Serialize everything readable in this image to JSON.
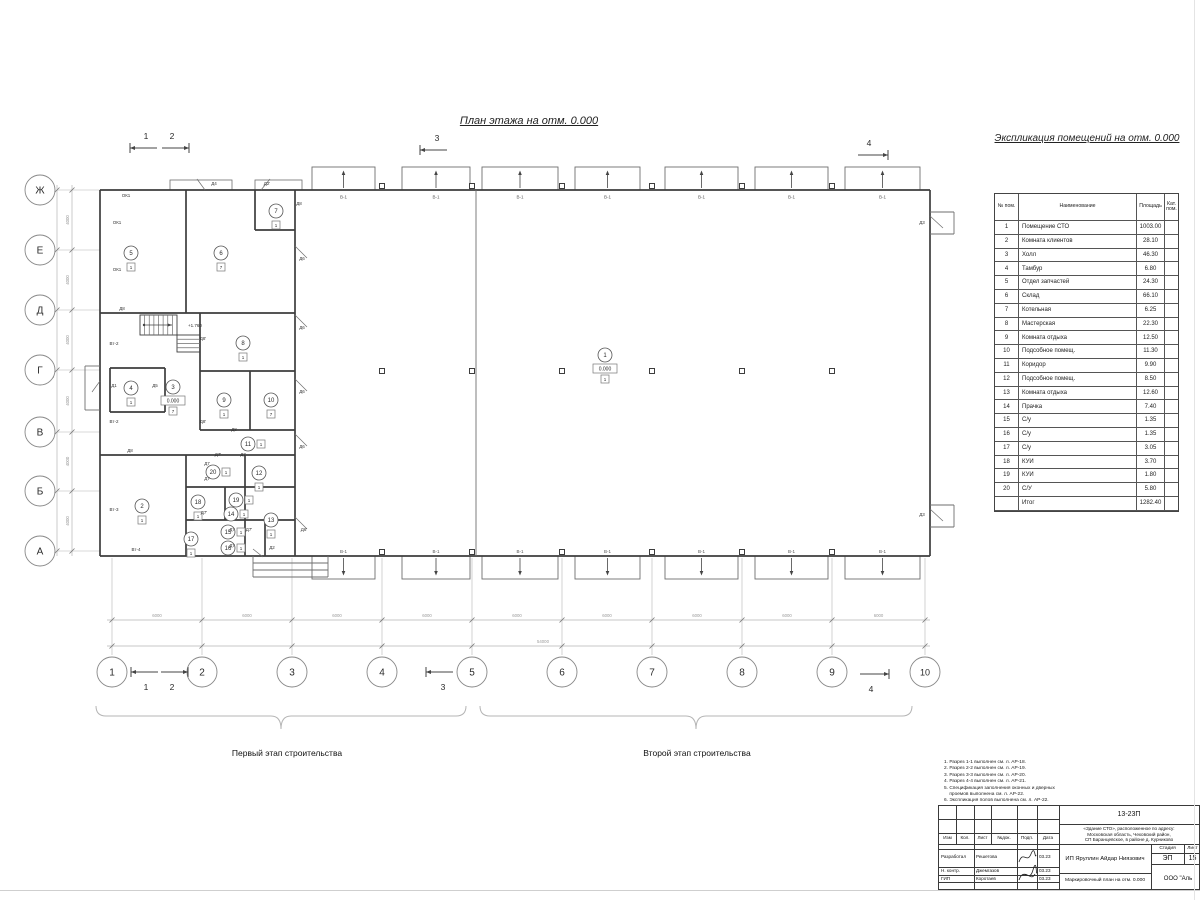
{
  "titles": {
    "plan": "План этажа на отм. 0.000",
    "schedule": "Экспликация помещений на отм. 0.000"
  },
  "stages": {
    "first": "Первый этап строительства",
    "second": "Второй этап строительства"
  },
  "schedule_table": {
    "headers": [
      "№ пом.",
      "Наименование",
      "Площадь",
      "Кат. пом."
    ],
    "rows": [
      [
        "1",
        "Помещение СТО",
        "1003.00",
        ""
      ],
      [
        "2",
        "Комната клиентов",
        "28.10",
        ""
      ],
      [
        "3",
        "Холл",
        "46.30",
        ""
      ],
      [
        "4",
        "Тамбур",
        "6.80",
        ""
      ],
      [
        "5",
        "Отдел запчастей",
        "24.30",
        ""
      ],
      [
        "6",
        "Склад",
        "66.10",
        ""
      ],
      [
        "7",
        "Котельная",
        "6.25",
        ""
      ],
      [
        "8",
        "Мастерская",
        "22.30",
        ""
      ],
      [
        "9",
        "Комната отдыха",
        "12.50",
        ""
      ],
      [
        "10",
        "Подсобное помещ.",
        "11.30",
        ""
      ],
      [
        "11",
        "Коридор",
        "9.90",
        ""
      ],
      [
        "12",
        "Подсобное помещ.",
        "8.50",
        ""
      ],
      [
        "13",
        "Комната отдыха",
        "12.60",
        ""
      ],
      [
        "14",
        "Прачка",
        "7.40",
        ""
      ],
      [
        "15",
        "С/у",
        "1.35",
        ""
      ],
      [
        "16",
        "С/у",
        "1.35",
        ""
      ],
      [
        "17",
        "С/у",
        "3.05",
        ""
      ],
      [
        "18",
        "КУИ",
        "3.70",
        ""
      ],
      [
        "19",
        "КУИ",
        "1.80",
        ""
      ],
      [
        "20",
        "С/У",
        "5.80",
        ""
      ],
      [
        "",
        "Итог",
        "1282.40",
        ""
      ]
    ]
  },
  "notes": {
    "lines": [
      "1. Разрез 1-1 выполнен см. л. АР-18.",
      "2. Разрез 2-2 выполнен см. л. АР-19.",
      "3. Разрез 3-3 выполнен см. л. АР-20.",
      "4. Разрез 4-4 выполнен см. л. АР-21.",
      "5. Спецификация заполнения оконных и дверных",
      "    проемов выполнена см. л. АР-22.",
      "6. Экспликация полов выполнена см. л. АР-22."
    ]
  },
  "titleblock": {
    "doc_number": "13-23П",
    "object_lines": [
      "«Здание СТО», расположенное по адресу:",
      "Московская область, Чеховский район,",
      "СП Баранцевское, в районе д. Курниково"
    ],
    "columns": [
      "Изм",
      "Кол.",
      "Лист",
      "№док.",
      "Подп.",
      "Дата"
    ],
    "roles": [
      {
        "role": "Разработал",
        "name": "Решетова",
        "date": "03.23"
      },
      {
        "role": "Н. контр.",
        "name": "Джемгазов",
        "date": "03.23"
      },
      {
        "role": "ГИП",
        "name": "Коротаев",
        "date": "03.23"
      }
    ],
    "client": "ИП Яруллин Айдар Ниязович",
    "stage_label": "Стадия",
    "sheet_label": "Лист",
    "stage": "ЭП",
    "sheet": "15",
    "drawing_title": "Маркировочный план на отм. 0.000",
    "company": "ООО \"Аль"
  },
  "plan": {
    "colors": {
      "dark": "#3d3d3d",
      "mid": "#6e6e6e",
      "light": "#b5b5b5",
      "dim": "#9a9a9a",
      "text": "#2a2a2a"
    },
    "gate_label": "В-1",
    "stair_note": "+1.760",
    "dim_seg_bottom": "6000",
    "dim_total_bottom": "54000",
    "dim_seg_left": "4000",
    "dim_total_left": "24000",
    "axes_bottom": [
      {
        "n": "1",
        "x": 112
      },
      {
        "n": "2",
        "x": 202
      },
      {
        "n": "3",
        "x": 292
      },
      {
        "n": "4",
        "x": 382
      },
      {
        "n": "5",
        "x": 472
      },
      {
        "n": "6",
        "x": 562
      },
      {
        "n": "7",
        "x": 652
      },
      {
        "n": "8",
        "x": 742
      },
      {
        "n": "9",
        "x": 832
      },
      {
        "n": "10",
        "x": 925
      }
    ],
    "axes_left": [
      {
        "n": "Ж",
        "y": 190
      },
      {
        "n": "Е",
        "y": 250
      },
      {
        "n": "Д",
        "y": 310
      },
      {
        "n": "Г",
        "y": 370
      },
      {
        "n": "В",
        "y": 432
      },
      {
        "n": "Б",
        "y": 491
      },
      {
        "n": "А",
        "y": 551
      }
    ],
    "bays": [
      [
        312,
        375
      ],
      [
        402,
        470
      ],
      [
        482,
        558
      ],
      [
        575,
        640
      ],
      [
        665,
        738
      ],
      [
        755,
        828
      ],
      [
        845,
        920
      ]
    ],
    "canopies": [
      [
        170,
        232
      ],
      [
        255,
        302
      ]
    ],
    "column_xs": [
      382,
      472,
      562,
      652,
      742,
      832
    ],
    "walls_main": [
      [
        100,
        190,
        930,
        190
      ],
      [
        100,
        556,
        930,
        556
      ],
      [
        100,
        190,
        100,
        556
      ],
      [
        930,
        190,
        930,
        556
      ],
      [
        100,
        313,
        295,
        313
      ],
      [
        186,
        190,
        186,
        313
      ],
      [
        255,
        190,
        255,
        230
      ],
      [
        255,
        230,
        295,
        230
      ],
      [
        295,
        190,
        295,
        556
      ],
      [
        200,
        313,
        200,
        430
      ],
      [
        200,
        371,
        295,
        371
      ],
      [
        250,
        371,
        250,
        430
      ],
      [
        200,
        430,
        295,
        430
      ],
      [
        100,
        455,
        295,
        455
      ],
      [
        186,
        455,
        186,
        556
      ],
      [
        245,
        455,
        245,
        556
      ],
      [
        186,
        487,
        295,
        487
      ],
      [
        186,
        520,
        295,
        520
      ],
      [
        265,
        520,
        265,
        556
      ],
      [
        225,
        487,
        225,
        520
      ],
      [
        110,
        368,
        165,
        368
      ],
      [
        110,
        368,
        110,
        412
      ],
      [
        165,
        368,
        165,
        412
      ],
      [
        110,
        412,
        165,
        412
      ]
    ],
    "walls_thin": [
      [
        476,
        190,
        476,
        556
      ],
      [
        85,
        366,
        100,
        366
      ],
      [
        85,
        366,
        85,
        410
      ],
      [
        85,
        410,
        100,
        410
      ],
      [
        930,
        212,
        954,
        212
      ],
      [
        954,
        212,
        954,
        234
      ],
      [
        930,
        234,
        954,
        234
      ],
      [
        930,
        505,
        954,
        505
      ],
      [
        954,
        505,
        954,
        527
      ],
      [
        930,
        527,
        954,
        527
      ],
      [
        253,
        556,
        253,
        577
      ],
      [
        253,
        577,
        328,
        577
      ],
      [
        328,
        556,
        328,
        577
      ],
      [
        253,
        563,
        328,
        563
      ],
      [
        253,
        570,
        328,
        570
      ]
    ],
    "deco_lines": [
      [
        205,
        190,
        197,
        179
      ],
      [
        261,
        190,
        270,
        179
      ],
      [
        295,
        246,
        307,
        258
      ],
      [
        295,
        315,
        307,
        327
      ],
      [
        295,
        379,
        307,
        391
      ],
      [
        295,
        434,
        307,
        446
      ],
      [
        295,
        517,
        307,
        529
      ],
      [
        930,
        216,
        943,
        228
      ],
      [
        930,
        509,
        943,
        521
      ],
      [
        100,
        381,
        92,
        392
      ],
      [
        253,
        549,
        263,
        557
      ]
    ],
    "stairs": {
      "f1": [
        140,
        315,
        37,
        20,
        8
      ],
      "f2": [
        177,
        335,
        23,
        17,
        4
      ]
    },
    "rooms": [
      {
        "n": "1",
        "x": 605,
        "y": 355,
        "elev": "0.000",
        "cat": "1"
      },
      {
        "n": "2",
        "x": 142,
        "y": 506,
        "cat": "1"
      },
      {
        "n": "3",
        "x": 173,
        "y": 387,
        "elev": "0.000",
        "cat": "7"
      },
      {
        "n": "4",
        "x": 131,
        "y": 388,
        "cat": "1"
      },
      {
        "n": "5",
        "x": 131,
        "y": 253,
        "cat": "1"
      },
      {
        "n": "6",
        "x": 221,
        "y": 253,
        "cat": "7"
      },
      {
        "n": "7",
        "x": 276,
        "y": 211,
        "cat": "1"
      },
      {
        "n": "8",
        "x": 243,
        "y": 343,
        "cat": "1"
      },
      {
        "n": "9",
        "x": 224,
        "y": 400,
        "cat": "1"
      },
      {
        "n": "10",
        "x": 271,
        "y": 400,
        "cat": "7"
      },
      {
        "n": "11",
        "x": 248,
        "y": 444,
        "cat": "1",
        "catside": "right"
      },
      {
        "n": "12",
        "x": 259,
        "y": 473,
        "cat": "1"
      },
      {
        "n": "13",
        "x": 271,
        "y": 520,
        "cat": "1"
      },
      {
        "n": "14",
        "x": 231,
        "y": 514,
        "cat": "1",
        "catside": "right"
      },
      {
        "n": "15",
        "x": 228,
        "y": 532,
        "cat": "1",
        "catside": "right"
      },
      {
        "n": "16",
        "x": 228,
        "y": 548,
        "cat": "1",
        "catside": "right"
      },
      {
        "n": "17",
        "x": 191,
        "y": 539,
        "cat": "1"
      },
      {
        "n": "18",
        "x": 198,
        "y": 502,
        "cat": "1"
      },
      {
        "n": "19",
        "x": 236,
        "y": 500,
        "cat": "1",
        "catside": "right"
      },
      {
        "n": "20",
        "x": 213,
        "y": 472,
        "cat": "1",
        "catside": "right"
      }
    ],
    "door_labels": [
      {
        "t": "ОК1",
        "x": 126,
        "y": 197
      },
      {
        "t": "ОК1",
        "x": 117,
        "y": 224
      },
      {
        "t": "ОК1",
        "x": 117,
        "y": 271
      },
      {
        "t": "Д8",
        "x": 122,
        "y": 310
      },
      {
        "t": "Вт-2",
        "x": 114,
        "y": 345
      },
      {
        "t": "Вт-2",
        "x": 114,
        "y": 423
      },
      {
        "t": "Вт-3",
        "x": 114,
        "y": 511
      },
      {
        "t": "Вт-4",
        "x": 136,
        "y": 551
      },
      {
        "t": "Д4",
        "x": 214,
        "y": 185
      },
      {
        "t": "Д2'",
        "x": 267,
        "y": 185
      },
      {
        "t": "Д8",
        "x": 299,
        "y": 205
      },
      {
        "t": "Д6",
        "x": 302,
        "y": 260
      },
      {
        "t": "Д6",
        "x": 302,
        "y": 329
      },
      {
        "t": "Д6",
        "x": 302,
        "y": 393
      },
      {
        "t": "Д6",
        "x": 302,
        "y": 448
      },
      {
        "t": "Д6'",
        "x": 304,
        "y": 531
      },
      {
        "t": "Д1",
        "x": 114,
        "y": 387
      },
      {
        "t": "Д5",
        "x": 155,
        "y": 387
      },
      {
        "t": "Д8'",
        "x": 203,
        "y": 340
      },
      {
        "t": "Д8'",
        "x": 203,
        "y": 423
      },
      {
        "t": "Д8",
        "x": 234,
        "y": 431
      },
      {
        "t": "Д8",
        "x": 130,
        "y": 452
      },
      {
        "t": "Д7'",
        "x": 218,
        "y": 456
      },
      {
        "t": "Д7",
        "x": 243,
        "y": 456
      },
      {
        "t": "Д7",
        "x": 207,
        "y": 465
      },
      {
        "t": "Д7",
        "x": 207,
        "y": 480
      },
      {
        "t": "Д7'",
        "x": 204,
        "y": 514
      },
      {
        "t": "Д7",
        "x": 232,
        "y": 531
      },
      {
        "t": "Д7'",
        "x": 249,
        "y": 531
      },
      {
        "t": "Д7",
        "x": 232,
        "y": 547
      },
      {
        "t": "Д2",
        "x": 272,
        "y": 549
      },
      {
        "t": "Д3",
        "x": 922,
        "y": 224
      },
      {
        "t": "Д3",
        "x": 922,
        "y": 516
      }
    ],
    "section_markers": [
      {
        "n": "1",
        "tx": 146,
        "ty": 139,
        "x1": 157,
        "x2": 130,
        "y": 148,
        "head": "l"
      },
      {
        "n": "2",
        "tx": 172,
        "ty": 139,
        "x1": 162,
        "x2": 189,
        "y": 148,
        "head": "r"
      },
      {
        "n": "3",
        "tx": 437,
        "ty": 141,
        "x1": 447,
        "x2": 420,
        "y": 150,
        "head": "l"
      },
      {
        "n": "4",
        "tx": 869,
        "ty": 146,
        "x1": 858,
        "x2": 888,
        "y": 155,
        "head": "r"
      },
      {
        "n": "1",
        "tx": 146,
        "ty": 690,
        "x1": 158,
        "x2": 131,
        "y": 672,
        "head": "l"
      },
      {
        "n": "2",
        "tx": 172,
        "ty": 690,
        "x1": 161,
        "x2": 188,
        "y": 672,
        "head": "r"
      },
      {
        "n": "3",
        "tx": 443,
        "ty": 690,
        "x1": 453,
        "x2": 426,
        "y": 672,
        "head": "l"
      },
      {
        "n": "4",
        "tx": 871,
        "ty": 692,
        "x1": 860,
        "x2": 889,
        "y": 674,
        "head": "r"
      }
    ],
    "braces": [
      {
        "x1": 96,
        "x2": 466,
        "tip": 281
      },
      {
        "x1": 480,
        "x2": 912,
        "tip": 696
      }
    ]
  }
}
